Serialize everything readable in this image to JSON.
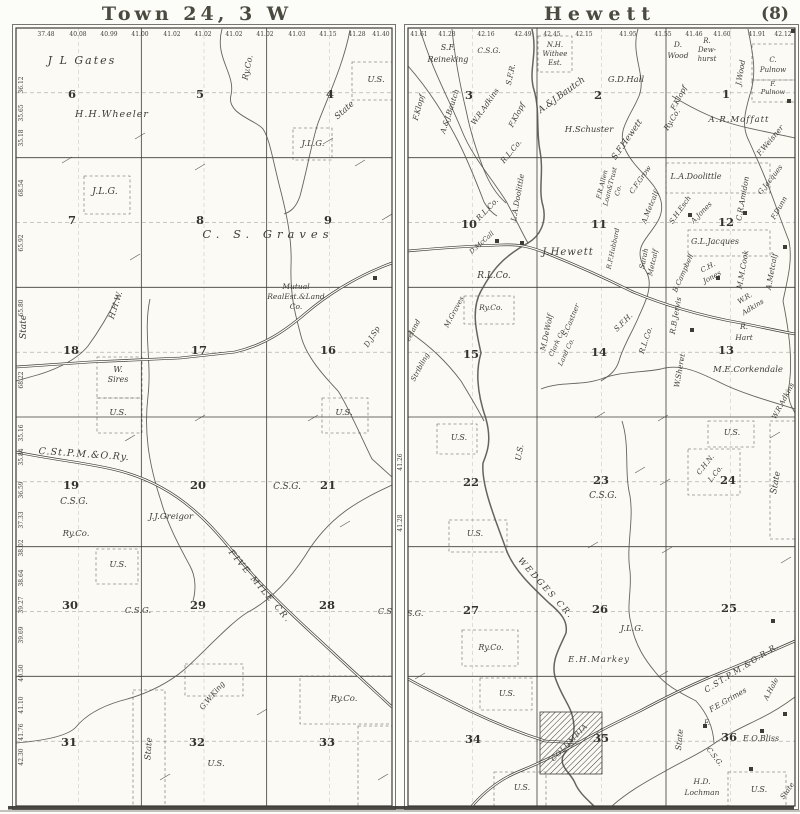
{
  "page": {
    "number": "(8)",
    "ink_color": "#3e3d35",
    "paper_color": "#fbfaf5"
  },
  "west": {
    "title": "Town 24, 3 W",
    "top_numbers": [
      {
        "t": "37.48",
        "x": 46
      },
      {
        "t": "40.08",
        "x": 78
      },
      {
        "t": "40.99",
        "x": 109
      },
      {
        "t": "41.00",
        "x": 140
      },
      {
        "t": "41.02",
        "x": 172
      },
      {
        "t": "41.02",
        "x": 203
      },
      {
        "t": "41.02",
        "x": 234
      },
      {
        "t": "41.02",
        "x": 265
      },
      {
        "t": "41.03",
        "x": 297
      },
      {
        "t": "41.15",
        "x": 328
      },
      {
        "t": "41.28",
        "x": 357
      },
      {
        "t": "41.40",
        "x": 381
      }
    ],
    "left_numbers": [
      {
        "t": "36.12",
        "y": 85
      },
      {
        "t": "35.65",
        "y": 113
      },
      {
        "t": "35.18",
        "y": 138
      },
      {
        "t": "68.54",
        "y": 188
      },
      {
        "t": "65.92",
        "y": 243
      },
      {
        "t": "65.80",
        "y": 308
      },
      {
        "t": "68.22",
        "y": 380
      },
      {
        "t": "35.16",
        "y": 433
      },
      {
        "t": "35.84",
        "y": 457
      },
      {
        "t": "36.59",
        "y": 490
      },
      {
        "t": "37.33",
        "y": 520
      },
      {
        "t": "38.02",
        "y": 548
      },
      {
        "t": "38.64",
        "y": 578
      },
      {
        "t": "39.27",
        "y": 605
      },
      {
        "t": "39.69",
        "y": 635
      },
      {
        "t": "40.50",
        "y": 673
      },
      {
        "t": "41.10",
        "y": 705
      },
      {
        "t": "41.76",
        "y": 732
      },
      {
        "t": "42.30",
        "y": 757
      }
    ],
    "sections": [
      {
        "n": "6",
        "x": 72,
        "y": 98
      },
      {
        "n": "5",
        "x": 200,
        "y": 98
      },
      {
        "n": "4",
        "x": 330,
        "y": 98
      },
      {
        "n": "7",
        "x": 72,
        "y": 224
      },
      {
        "n": "8",
        "x": 200,
        "y": 224
      },
      {
        "n": "9",
        "x": 328,
        "y": 224
      },
      {
        "n": "18",
        "x": 71,
        "y": 354
      },
      {
        "n": "17",
        "x": 199,
        "y": 354
      },
      {
        "n": "16",
        "x": 328,
        "y": 354
      },
      {
        "n": "19",
        "x": 71,
        "y": 489
      },
      {
        "n": "20",
        "x": 198,
        "y": 489
      },
      {
        "n": "21",
        "x": 328,
        "y": 489
      },
      {
        "n": "30",
        "x": 70,
        "y": 609
      },
      {
        "n": "29",
        "x": 198,
        "y": 609
      },
      {
        "n": "28",
        "x": 327,
        "y": 609
      },
      {
        "n": "31",
        "x": 69,
        "y": 746
      },
      {
        "n": "32",
        "x": 197,
        "y": 746
      },
      {
        "n": "33",
        "x": 327,
        "y": 746
      }
    ],
    "labels": [
      {
        "t": "J L Gates",
        "x": 82,
        "y": 64,
        "s": 11,
        "sp": 2
      },
      {
        "t": "H.H.Wheeler",
        "x": 112,
        "y": 117,
        "s": 9.5,
        "sp": 1
      },
      {
        "t": "Ry.Co.",
        "x": 250,
        "y": 68,
        "r": -78,
        "s": 8
      },
      {
        "t": "U.S.",
        "x": 376,
        "y": 82,
        "s": 8.5
      },
      {
        "t": "State",
        "x": 346,
        "y": 112,
        "r": -42,
        "s": 8.5
      },
      {
        "t": "J.L.G.",
        "x": 313,
        "y": 146,
        "s": 8.5
      },
      {
        "t": "J.L.G.",
        "x": 105,
        "y": 194,
        "s": 9.5
      },
      {
        "t": "C. S. Graves",
        "x": 268,
        "y": 238,
        "s": 11.5,
        "sp": 5
      },
      {
        "t": "H.H.W.",
        "x": 118,
        "y": 306,
        "r": -72,
        "s": 8
      },
      {
        "t": "State",
        "x": 26,
        "y": 327,
        "r": -90,
        "s": 9
      },
      {
        "t": "Mutual",
        "x": 296,
        "y": 289,
        "s": 7.5
      },
      {
        "t": "RealEst.&Land",
        "x": 296,
        "y": 299,
        "s": 7.5
      },
      {
        "t": "Co.",
        "x": 296,
        "y": 309,
        "s": 7.5
      },
      {
        "t": "D.J.Sp",
        "x": 374,
        "y": 338,
        "r": -58,
        "s": 7.5
      },
      {
        "t": "W.",
        "x": 118,
        "y": 372,
        "s": 8
      },
      {
        "t": "Sires",
        "x": 118,
        "y": 382,
        "s": 8
      },
      {
        "t": "U.S.",
        "x": 118,
        "y": 415,
        "s": 8.5
      },
      {
        "t": "U.S.",
        "x": 344,
        "y": 415,
        "s": 8.5
      },
      {
        "t": "C.St.P.M.&O.Ry.",
        "x": 84,
        "y": 457,
        "r": 4,
        "s": 9.5,
        "sp": 1,
        "nm": "railroad-label"
      },
      {
        "t": "C.S.G.",
        "x": 287,
        "y": 489,
        "s": 9
      },
      {
        "t": "C.S.G.",
        "x": 74,
        "y": 504,
        "s": 9
      },
      {
        "t": "J.J.Greigor",
        "x": 171,
        "y": 519,
        "s": 8.5
      },
      {
        "t": "Ry.Co.",
        "x": 76,
        "y": 536,
        "s": 8.5
      },
      {
        "t": "U.S.",
        "x": 118,
        "y": 567,
        "s": 8.5
      },
      {
        "t": "C.S.G.",
        "x": 138,
        "y": 613,
        "s": 8.5
      },
      {
        "t": "C.S.",
        "x": 386,
        "y": 614,
        "s": 8
      },
      {
        "t": "FIVE MILE CR.",
        "x": 258,
        "y": 588,
        "r": 50,
        "s": 8.5,
        "sp": 2,
        "nm": "creek-label-five-mile"
      },
      {
        "t": "G.W.King",
        "x": 214,
        "y": 697,
        "r": -50,
        "s": 7.5
      },
      {
        "t": "State",
        "x": 151,
        "y": 749,
        "r": -86,
        "s": 8.5
      },
      {
        "t": "U.S.",
        "x": 216,
        "y": 766,
        "s": 8.5
      },
      {
        "t": "Ry.Co.",
        "x": 344,
        "y": 701,
        "s": 8.5
      }
    ]
  },
  "east": {
    "title": "Hewett",
    "top_numbers": [
      {
        "t": "41.61",
        "x": 419
      },
      {
        "t": "41.28",
        "x": 447
      },
      {
        "t": "42.16",
        "x": 486
      },
      {
        "t": "42.49",
        "x": 523
      },
      {
        "t": "42.45",
        "x": 552
      },
      {
        "t": "42.15",
        "x": 584
      },
      {
        "t": "41.95",
        "x": 628
      },
      {
        "t": "41.55",
        "x": 663
      },
      {
        "t": "41.46",
        "x": 694
      },
      {
        "t": "41.60",
        "x": 722
      },
      {
        "t": "41.91",
        "x": 757
      },
      {
        "t": "42.12",
        "x": 783
      }
    ],
    "left_numbers": [
      {
        "t": "41.26",
        "y": 462
      },
      {
        "t": "41.28",
        "y": 523
      }
    ],
    "sections": [
      {
        "n": "3",
        "x": 469,
        "y": 99
      },
      {
        "n": "2",
        "x": 598,
        "y": 99
      },
      {
        "n": "1",
        "x": 726,
        "y": 98
      },
      {
        "n": "10",
        "x": 469,
        "y": 228
      },
      {
        "n": "11",
        "x": 599,
        "y": 228
      },
      {
        "n": "12",
        "x": 726,
        "y": 226
      },
      {
        "n": "15",
        "x": 471,
        "y": 358
      },
      {
        "n": "14",
        "x": 599,
        "y": 356
      },
      {
        "n": "13",
        "x": 726,
        "y": 354
      },
      {
        "n": "22",
        "x": 471,
        "y": 486
      },
      {
        "n": "23",
        "x": 601,
        "y": 484
      },
      {
        "n": "24",
        "x": 728,
        "y": 484
      },
      {
        "n": "27",
        "x": 471,
        "y": 614
      },
      {
        "n": "26",
        "x": 600,
        "y": 613
      },
      {
        "n": "25",
        "x": 729,
        "y": 612
      },
      {
        "n": "34",
        "x": 473,
        "y": 743
      },
      {
        "n": "35",
        "x": 601,
        "y": 742
      },
      {
        "n": "36",
        "x": 729,
        "y": 741
      }
    ],
    "labels": [
      {
        "t": "S.F.",
        "x": 448,
        "y": 50,
        "s": 8
      },
      {
        "t": "Reineking",
        "x": 448,
        "y": 62,
        "s": 8
      },
      {
        "t": "C.S.G.",
        "x": 489,
        "y": 53,
        "s": 7.5
      },
      {
        "t": "F.Klopf",
        "x": 421,
        "y": 108,
        "r": -75,
        "s": 7.5
      },
      {
        "t": "A.&J.Bautch",
        "x": 452,
        "y": 112,
        "r": -72,
        "s": 7.5
      },
      {
        "t": "W.R.Adkins",
        "x": 487,
        "y": 108,
        "r": -55,
        "s": 7.5
      },
      {
        "t": "S.F.R.",
        "x": 513,
        "y": 75,
        "r": -78,
        "s": 7.5
      },
      {
        "t": "F.Klopf",
        "x": 519,
        "y": 116,
        "r": -62,
        "s": 7.5
      },
      {
        "t": "R.L.Co.",
        "x": 513,
        "y": 153,
        "r": -50,
        "s": 7.5
      },
      {
        "t": "N.H.",
        "x": 555,
        "y": 47,
        "s": 7
      },
      {
        "t": "Withee",
        "x": 555,
        "y": 56,
        "s": 7
      },
      {
        "t": "Est.",
        "x": 555,
        "y": 65,
        "s": 7
      },
      {
        "t": "A.&J.Bautch",
        "x": 563,
        "y": 97,
        "r": -36,
        "s": 9
      },
      {
        "t": "G.D.Hall",
        "x": 626,
        "y": 82,
        "s": 8.5
      },
      {
        "t": "H.Schuster",
        "x": 589,
        "y": 132,
        "s": 8.5
      },
      {
        "t": "S.F.Hewett",
        "x": 629,
        "y": 141,
        "r": -55,
        "s": 8.5
      },
      {
        "t": "D.",
        "x": 678,
        "y": 47,
        "s": 7.5
      },
      {
        "t": "Wood",
        "x": 678,
        "y": 58,
        "s": 7.5
      },
      {
        "t": "R.",
        "x": 707,
        "y": 43,
        "s": 7
      },
      {
        "t": "Dew-",
        "x": 707,
        "y": 52,
        "s": 7
      },
      {
        "t": "hurst",
        "x": 707,
        "y": 61,
        "s": 7
      },
      {
        "t": "F.Klopf",
        "x": 681,
        "y": 99,
        "r": -62,
        "s": 7.5
      },
      {
        "t": "Ry.Co.",
        "x": 674,
        "y": 121,
        "r": -58,
        "s": 7.5
      },
      {
        "t": "J.Wood",
        "x": 743,
        "y": 73,
        "r": -80,
        "s": 7.5
      },
      {
        "t": "C.",
        "x": 773,
        "y": 62,
        "s": 7
      },
      {
        "t": "Pulnow",
        "x": 773,
        "y": 72,
        "s": 7
      },
      {
        "t": "F.",
        "x": 773,
        "y": 86,
        "s": 6.5
      },
      {
        "t": "Pulnow",
        "x": 773,
        "y": 94,
        "s": 6.5
      },
      {
        "t": "A.R.Moffatt",
        "x": 739,
        "y": 122,
        "s": 8.5,
        "sp": 1
      },
      {
        "t": "F.Weisner",
        "x": 772,
        "y": 142,
        "r": -50,
        "s": 7.5
      },
      {
        "t": "R.L.Co.",
        "x": 489,
        "y": 211,
        "r": -46,
        "s": 7.5
      },
      {
        "t": "L.A.Doolittle",
        "x": 520,
        "y": 198,
        "r": -80,
        "s": 7.5
      },
      {
        "t": "D.McCall",
        "x": 483,
        "y": 244,
        "r": -42,
        "s": 6.5
      },
      {
        "t": "J.Hewett",
        "x": 568,
        "y": 255,
        "s": 10,
        "sp": 1
      },
      {
        "t": "R.L.Co.",
        "x": 494,
        "y": 278,
        "s": 9
      },
      {
        "t": "F.R.Allen",
        "x": 604,
        "y": 185,
        "r": -76,
        "s": 6.5
      },
      {
        "t": "Loan&Trust",
        "x": 612,
        "y": 187,
        "r": -76,
        "s": 6.5
      },
      {
        "t": "Co.",
        "x": 620,
        "y": 191,
        "r": -76,
        "s": 6.5
      },
      {
        "t": "C.F.Grow",
        "x": 642,
        "y": 181,
        "r": -55,
        "s": 7
      },
      {
        "t": "A.Metcalf",
        "x": 652,
        "y": 208,
        "r": -68,
        "s": 7
      },
      {
        "t": "R.F.Hubbard",
        "x": 615,
        "y": 249,
        "r": -78,
        "s": 6.5
      },
      {
        "t": "Sarah",
        "x": 646,
        "y": 259,
        "r": -78,
        "s": 7
      },
      {
        "t": "Metcalf",
        "x": 655,
        "y": 263,
        "r": -78,
        "s": 7
      },
      {
        "t": "M.DeWolf",
        "x": 549,
        "y": 333,
        "r": -78,
        "s": 7.5
      },
      {
        "t": "S.Castner",
        "x": 573,
        "y": 321,
        "r": -68,
        "s": 7
      },
      {
        "t": "Clark Co.",
        "x": 559,
        "y": 343,
        "r": -65,
        "s": 6.5
      },
      {
        "t": "Land Co.",
        "x": 568,
        "y": 353,
        "r": -65,
        "s": 6.5
      },
      {
        "t": "M.Graves",
        "x": 456,
        "y": 313,
        "r": -62,
        "s": 7
      },
      {
        "t": "Ry.Co.",
        "x": 491,
        "y": 310,
        "s": 7.5
      },
      {
        "t": "S.F.H.",
        "x": 625,
        "y": 324,
        "r": -45,
        "s": 7.5
      },
      {
        "t": "R.L.Co.",
        "x": 648,
        "y": 341,
        "r": -72,
        "s": 7.5
      },
      {
        "t": "R.B.Jervis",
        "x": 678,
        "y": 316,
        "r": -80,
        "s": 7.5
      },
      {
        "t": "L.A.Doolittle",
        "x": 696,
        "y": 179,
        "s": 8
      },
      {
        "t": "S.H.Esch",
        "x": 682,
        "y": 211,
        "r": -55,
        "s": 7
      },
      {
        "t": "A.Jones",
        "x": 703,
        "y": 214,
        "r": -46,
        "s": 7
      },
      {
        "t": "C.R.Amidon",
        "x": 745,
        "y": 199,
        "r": -80,
        "s": 7.5
      },
      {
        "t": "G.Jacques",
        "x": 772,
        "y": 181,
        "r": -52,
        "s": 7
      },
      {
        "t": "F.Dunn",
        "x": 781,
        "y": 209,
        "r": -60,
        "s": 7
      },
      {
        "t": "G.L.Jacques",
        "x": 715,
        "y": 244,
        "s": 8
      },
      {
        "t": "B.Campbell",
        "x": 685,
        "y": 274,
        "r": -66,
        "s": 7
      },
      {
        "t": "C.H.",
        "x": 709,
        "y": 269,
        "r": -28,
        "s": 7
      },
      {
        "t": "Jones",
        "x": 713,
        "y": 279,
        "r": -28,
        "s": 7
      },
      {
        "t": "M.M.Cook",
        "x": 745,
        "y": 270,
        "r": -80,
        "s": 7.5
      },
      {
        "t": "A.Metcalf",
        "x": 774,
        "y": 272,
        "r": -80,
        "s": 7.5
      },
      {
        "t": "W.R.",
        "x": 746,
        "y": 300,
        "r": -32,
        "s": 7
      },
      {
        "t": "Adkins",
        "x": 754,
        "y": 309,
        "r": -32,
        "s": 7
      },
      {
        "t": "R.",
        "x": 744,
        "y": 329,
        "s": 7.5
      },
      {
        "t": "Hart",
        "x": 744,
        "y": 340,
        "s": 7.5
      },
      {
        "t": "W.Sheret",
        "x": 682,
        "y": 371,
        "r": -80,
        "s": 7.5
      },
      {
        "t": "M.E.Corkendale",
        "x": 748,
        "y": 372,
        "s": 8.5
      },
      {
        "t": "W.R.Adkins",
        "x": 785,
        "y": 402,
        "r": -62,
        "s": 7
      },
      {
        "t": "Freeland",
        "x": 413,
        "y": 335,
        "r": -62,
        "s": 7
      },
      {
        "t": "Stribling",
        "x": 422,
        "y": 368,
        "r": -62,
        "s": 7
      },
      {
        "t": "U.S.",
        "x": 459,
        "y": 440,
        "s": 8
      },
      {
        "t": "U.S.",
        "x": 522,
        "y": 453,
        "r": -80,
        "s": 8
      },
      {
        "t": "U.S.",
        "x": 475,
        "y": 536,
        "s": 8
      },
      {
        "t": "C.S.G.",
        "x": 603,
        "y": 498,
        "s": 9
      },
      {
        "t": "U.S.",
        "x": 732,
        "y": 435,
        "s": 8
      },
      {
        "t": "C.H.N.",
        "x": 707,
        "y": 466,
        "r": -52,
        "s": 7
      },
      {
        "t": "L.Co.",
        "x": 717,
        "y": 475,
        "r": -52,
        "s": 7
      },
      {
        "t": "State",
        "x": 778,
        "y": 483,
        "r": -80,
        "s": 8.5
      },
      {
        "t": "C.S.G.",
        "x": 411,
        "y": 616,
        "s": 8
      },
      {
        "t": "Ry.Co.",
        "x": 491,
        "y": 650,
        "s": 8
      },
      {
        "t": "WEDGES CR.",
        "x": 544,
        "y": 590,
        "r": 48,
        "s": 8.5,
        "sp": 2,
        "nm": "creek-label-wedges"
      },
      {
        "t": "J.L.G.",
        "x": 632,
        "y": 631,
        "s": 8.5
      },
      {
        "t": "E.H.Markey",
        "x": 599,
        "y": 662,
        "s": 8.5,
        "sp": 1
      },
      {
        "t": "U.S.",
        "x": 507,
        "y": 696,
        "s": 8
      },
      {
        "t": "U.S.",
        "x": 522,
        "y": 790,
        "s": 8
      },
      {
        "t": "COLUMBIA",
        "x": 571,
        "y": 744,
        "r": -46,
        "s": 7,
        "sp": 1,
        "nm": "village-label-columbia"
      },
      {
        "t": "C.ST.P.M.&O.R.R.",
        "x": 743,
        "y": 670,
        "r": -32,
        "s": 8,
        "sp": 1,
        "nm": "railroad-label"
      },
      {
        "t": "F.E.Grimes",
        "x": 729,
        "y": 702,
        "r": -30,
        "s": 7.5
      },
      {
        "t": "A.Hale",
        "x": 773,
        "y": 690,
        "r": -62,
        "s": 7
      },
      {
        "t": "State",
        "x": 682,
        "y": 740,
        "r": -84,
        "s": 8
      },
      {
        "t": "F.",
        "x": 707,
        "y": 725,
        "s": 7
      },
      {
        "t": "E.O.Bliss",
        "x": 761,
        "y": 741,
        "s": 8
      },
      {
        "t": "C.S.G.",
        "x": 713,
        "y": 758,
        "r": 52,
        "s": 7
      },
      {
        "t": "H.D.",
        "x": 702,
        "y": 784,
        "s": 7.5
      },
      {
        "t": "Lochman",
        "x": 702,
        "y": 795,
        "s": 7.5
      },
      {
        "t": "U.S.",
        "x": 759,
        "y": 792,
        "s": 8
      },
      {
        "t": "State",
        "x": 789,
        "y": 792,
        "r": -55,
        "s": 7
      }
    ]
  }
}
